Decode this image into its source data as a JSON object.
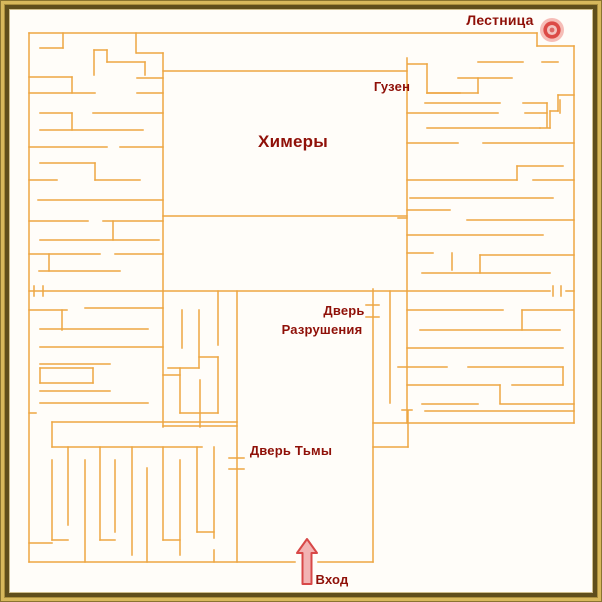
{
  "map": {
    "colors": {
      "background": "#fffdf9",
      "wall": "#eda643",
      "label": "#8f1008",
      "arrow_stroke": "#d84848",
      "arrow_fill": "#f2b3b3",
      "target_halo": "#f5b1ac",
      "target_ring": "#dc4a46",
      "target_inner": "#f3c4c0",
      "target_center": "#dd6663",
      "frame_gold": "#d7b85c",
      "frame_dark": "#5f4e1c"
    },
    "labels": [
      {
        "id": "stairs",
        "text": "Лестница",
        "x": 500,
        "y": 13,
        "size": 14
      },
      {
        "id": "guzen",
        "text": "Гузен",
        "x": 392,
        "y": 80,
        "size": 13
      },
      {
        "id": "chimeras",
        "text": "Химеры",
        "x": 293,
        "y": 133,
        "size": 17
      },
      {
        "id": "door-destruction-line1",
        "text": "Дверь",
        "x": 344,
        "y": 304,
        "size": 13
      },
      {
        "id": "door-destruction-line2",
        "text": "Разрушения",
        "x": 322,
        "y": 323,
        "size": 13
      },
      {
        "id": "door-darkness",
        "text": "Дверь Тьмы",
        "x": 291,
        "y": 444,
        "size": 13
      },
      {
        "id": "entrance",
        "text": "Вход",
        "x": 332,
        "y": 573,
        "size": 13
      }
    ],
    "icons": {
      "stairs_target": {
        "cx": 552,
        "cy": 30,
        "r": 12
      },
      "entrance_arrow": {
        "x": 307,
        "tip_y": 539,
        "base_y": 584,
        "head_w": 20,
        "head_h": 14,
        "shaft_w": 9
      }
    },
    "walls": [
      [
        29,
        33,
        537,
        33
      ],
      [
        29,
        33,
        29,
        562
      ],
      [
        29,
        562,
        295,
        562
      ],
      [
        318,
        562,
        373,
        562
      ],
      [
        537,
        33,
        537,
        46
      ],
      [
        537,
        46,
        574,
        46
      ],
      [
        574,
        46,
        574,
        423
      ],
      [
        373,
        423,
        574,
        423
      ],
      [
        373,
        289,
        373,
        562
      ],
      [
        373,
        447,
        408,
        447
      ],
      [
        408,
        411,
        408,
        447
      ],
      [
        390,
        291,
        390,
        403
      ],
      [
        366,
        305,
        379,
        305
      ],
      [
        366,
        317,
        379,
        317
      ],
      [
        402,
        410,
        412,
        410
      ],
      [
        237,
        291,
        237,
        562
      ],
      [
        229,
        458,
        244,
        458
      ],
      [
        229,
        469,
        244,
        469
      ],
      [
        163,
        71,
        407,
        71
      ],
      [
        163,
        291,
        407,
        291
      ],
      [
        407,
        291,
        550,
        291
      ],
      [
        566,
        291,
        574,
        291
      ],
      [
        553,
        286,
        553,
        296
      ],
      [
        561,
        286,
        561,
        296
      ],
      [
        163,
        53,
        163,
        427
      ],
      [
        137,
        53,
        163,
        53
      ],
      [
        407,
        58,
        407,
        423
      ],
      [
        163,
        216,
        407,
        216
      ],
      [
        398,
        218,
        407,
        218
      ],
      [
        408,
        64,
        427,
        64
      ],
      [
        427,
        64,
        427,
        93
      ],
      [
        427,
        93,
        460,
        93
      ],
      [
        40,
        48,
        63,
        48
      ],
      [
        63,
        33,
        63,
        48
      ],
      [
        136,
        33,
        136,
        53
      ],
      [
        94,
        50,
        107,
        50
      ],
      [
        94,
        50,
        94,
        75
      ],
      [
        107,
        50,
        107,
        62
      ],
      [
        107,
        62,
        145,
        62
      ],
      [
        145,
        62,
        145,
        75
      ],
      [
        29,
        77,
        72,
        77
      ],
      [
        72,
        77,
        72,
        93
      ],
      [
        137,
        78,
        163,
        78
      ],
      [
        29,
        93,
        95,
        93
      ],
      [
        137,
        93,
        163,
        93
      ],
      [
        40,
        113,
        72,
        113
      ],
      [
        72,
        113,
        72,
        130
      ],
      [
        93,
        113,
        163,
        113
      ],
      [
        40,
        130,
        143,
        130
      ],
      [
        29,
        147,
        107,
        147
      ],
      [
        120,
        147,
        163,
        147
      ],
      [
        40,
        163,
        95,
        163
      ],
      [
        95,
        163,
        95,
        180
      ],
      [
        29,
        180,
        57,
        180
      ],
      [
        95,
        180,
        140,
        180
      ],
      [
        38,
        200,
        163,
        200
      ],
      [
        29,
        221,
        88,
        221
      ],
      [
        103,
        221,
        163,
        221
      ],
      [
        113,
        221,
        113,
        240
      ],
      [
        40,
        240,
        159,
        240
      ],
      [
        29,
        254,
        100,
        254
      ],
      [
        115,
        254,
        163,
        254
      ],
      [
        49,
        254,
        49,
        271
      ],
      [
        39,
        271,
        120,
        271
      ],
      [
        29,
        291,
        163,
        291
      ],
      [
        34,
        286,
        34,
        296
      ],
      [
        43,
        286,
        43,
        296
      ],
      [
        85,
        308,
        163,
        308
      ],
      [
        29,
        310,
        67,
        310
      ],
      [
        62,
        310,
        62,
        330
      ],
      [
        40,
        329,
        148,
        329
      ],
      [
        40,
        347,
        163,
        347
      ],
      [
        40,
        364,
        110,
        364
      ],
      [
        40,
        368,
        93,
        368
      ],
      [
        93,
        368,
        93,
        383
      ],
      [
        40,
        383,
        93,
        383
      ],
      [
        40,
        368,
        40,
        383
      ],
      [
        40,
        391,
        110,
        391
      ],
      [
        40,
        403,
        148,
        403
      ],
      [
        29,
        413,
        36,
        413
      ],
      [
        218,
        291,
        218,
        345
      ],
      [
        182,
        310,
        182,
        348
      ],
      [
        199,
        310,
        199,
        368
      ],
      [
        199,
        357,
        218,
        357
      ],
      [
        168,
        368,
        199,
        368
      ],
      [
        163,
        375,
        180,
        375
      ],
      [
        218,
        357,
        218,
        413
      ],
      [
        180,
        368,
        180,
        413
      ],
      [
        200,
        380,
        200,
        427
      ],
      [
        180,
        413,
        218,
        413
      ],
      [
        163,
        426,
        237,
        426
      ],
      [
        52,
        422,
        237,
        422
      ],
      [
        52,
        447,
        202,
        447
      ],
      [
        52,
        422,
        52,
        447
      ],
      [
        52,
        460,
        52,
        540
      ],
      [
        52,
        540,
        68,
        540
      ],
      [
        68,
        447,
        68,
        525
      ],
      [
        85,
        460,
        85,
        562
      ],
      [
        100,
        447,
        100,
        540
      ],
      [
        100,
        540,
        115,
        540
      ],
      [
        115,
        460,
        115,
        532
      ],
      [
        132,
        447,
        132,
        555
      ],
      [
        147,
        468,
        147,
        562
      ],
      [
        163,
        447,
        163,
        540
      ],
      [
        163,
        540,
        180,
        540
      ],
      [
        180,
        460,
        180,
        555
      ],
      [
        197,
        447,
        197,
        532
      ],
      [
        197,
        532,
        214,
        532
      ],
      [
        214,
        447,
        214,
        538
      ],
      [
        214,
        550,
        214,
        562
      ],
      [
        29,
        543,
        52,
        543
      ],
      [
        478,
        62,
        523,
        62
      ],
      [
        542,
        62,
        558,
        62
      ],
      [
        458,
        78,
        512,
        78
      ],
      [
        478,
        78,
        478,
        93
      ],
      [
        427,
        93,
        478,
        93
      ],
      [
        558,
        95,
        574,
        95
      ],
      [
        558,
        95,
        558,
        111
      ],
      [
        550,
        111,
        558,
        111
      ],
      [
        550,
        111,
        550,
        128
      ],
      [
        540,
        128,
        550,
        128
      ],
      [
        425,
        103,
        500,
        103
      ],
      [
        523,
        103,
        547,
        103
      ],
      [
        560,
        100,
        560,
        113
      ],
      [
        547,
        103,
        547,
        127
      ],
      [
        407,
        113,
        498,
        113
      ],
      [
        525,
        113,
        547,
        113
      ],
      [
        427,
        128,
        540,
        128
      ],
      [
        407,
        143,
        458,
        143
      ],
      [
        483,
        143,
        574,
        143
      ],
      [
        517,
        166,
        563,
        166
      ],
      [
        517,
        166,
        517,
        180
      ],
      [
        407,
        180,
        517,
        180
      ],
      [
        533,
        180,
        574,
        180
      ],
      [
        410,
        198,
        553,
        198
      ],
      [
        467,
        220,
        574,
        220
      ],
      [
        407,
        210,
        450,
        210
      ],
      [
        407,
        235,
        543,
        235
      ],
      [
        407,
        253,
        433,
        253
      ],
      [
        452,
        253,
        452,
        270
      ],
      [
        480,
        255,
        480,
        273
      ],
      [
        480,
        255,
        574,
        255
      ],
      [
        422,
        273,
        550,
        273
      ],
      [
        407,
        310,
        503,
        310
      ],
      [
        522,
        310,
        573,
        310
      ],
      [
        522,
        310,
        522,
        330
      ],
      [
        420,
        330,
        560,
        330
      ],
      [
        407,
        348,
        563,
        348
      ],
      [
        398,
        367,
        447,
        367
      ],
      [
        468,
        367,
        563,
        367
      ],
      [
        563,
        367,
        563,
        385
      ],
      [
        407,
        385,
        500,
        385
      ],
      [
        500,
        385,
        500,
        403
      ],
      [
        512,
        385,
        563,
        385
      ],
      [
        422,
        404,
        478,
        404
      ],
      [
        500,
        404,
        574,
        404
      ],
      [
        425,
        411,
        574,
        411
      ]
    ]
  }
}
